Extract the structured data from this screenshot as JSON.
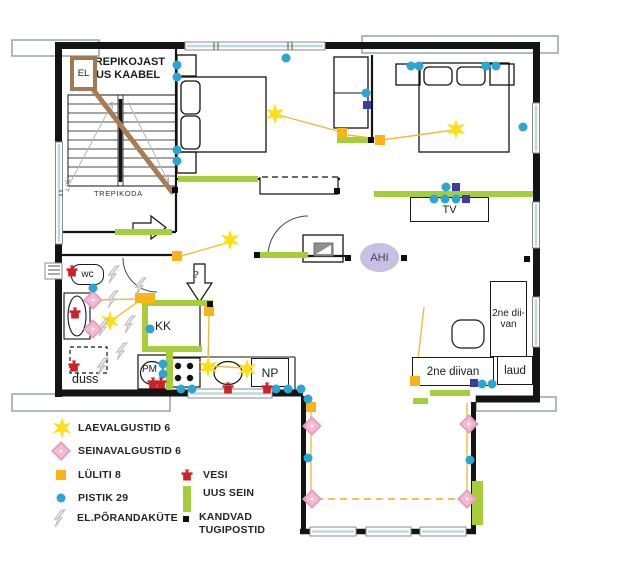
{
  "plan": {
    "labels": {
      "note": "TREPIKOJAST\nUUS KAABEL",
      "el": "EL",
      "trepikoda": "TREPIKODA",
      "stair_dim": "4.85",
      "wc": "wc",
      "duss": "duss",
      "kk": "KK",
      "pm": "PM",
      "np": "NP",
      "tv": "TV",
      "ahi": "AHI",
      "question": "?",
      "sofa_side": "2ne\ndii-\nvan",
      "sofa_bottom": "2ne diivan",
      "laud": "laud"
    },
    "symbols": {
      "ceiling_lights": [
        [
          275,
          114
        ],
        [
          456,
          129
        ],
        [
          230,
          240
        ],
        [
          110,
          321
        ],
        [
          208,
          367
        ],
        [
          247,
          369
        ]
      ],
      "wall_lights": [
        [
          93,
          300
        ],
        [
          93,
          329
        ],
        [
          312,
          426
        ],
        [
          312,
          499
        ],
        [
          469,
          424
        ],
        [
          467,
          499
        ]
      ],
      "switches": [
        [
          177,
          256
        ],
        [
          342,
          133
        ],
        [
          380,
          140
        ],
        [
          140,
          298
        ],
        [
          150,
          298
        ],
        [
          209,
          311
        ],
        [
          311,
          407
        ],
        [
          415,
          381
        ]
      ],
      "sockets": [
        [
          177,
          65
        ],
        [
          177,
          77
        ],
        [
          177,
          150
        ],
        [
          177,
          161
        ],
        [
          286,
          58
        ],
        [
          366,
          93
        ],
        [
          411,
          66
        ],
        [
          419,
          66
        ],
        [
          486,
          66
        ],
        [
          496,
          66
        ],
        [
          523,
          127
        ],
        [
          446,
          187
        ],
        [
          434,
          199
        ],
        [
          445,
          199
        ],
        [
          456,
          199
        ],
        [
          150,
          329
        ],
        [
          163,
          364
        ],
        [
          163,
          374
        ],
        [
          181,
          389
        ],
        [
          192,
          389
        ],
        [
          276,
          389
        ],
        [
          288,
          389
        ],
        [
          301,
          389
        ],
        [
          308,
          399
        ],
        [
          308,
          458
        ],
        [
          470,
          460
        ],
        [
          482,
          384
        ],
        [
          492,
          384
        ],
        [
          93,
          288
        ]
      ],
      "data_outlets": [
        [
          367,
          105
        ],
        [
          456,
          187
        ],
        [
          466,
          199
        ],
        [
          474,
          383
        ]
      ],
      "water_points": [
        [
          72,
          271
        ],
        [
          75,
          313
        ],
        [
          74,
          366
        ],
        [
          153,
          383
        ],
        [
          161,
          383
        ],
        [
          228,
          388
        ],
        [
          267,
          388
        ]
      ],
      "posts": [
        [
          175,
          190
        ],
        [
          257,
          255
        ],
        [
          337,
          191
        ],
        [
          371,
          140
        ],
        [
          348,
          258
        ],
        [
          404,
          258
        ],
        [
          527,
          259
        ],
        [
          210,
          304
        ]
      ],
      "floor_heating": [
        [
          114,
          274
        ],
        [
          141,
          286
        ],
        [
          113,
          299
        ],
        [
          104,
          327
        ],
        [
          130,
          324
        ],
        [
          122,
          351
        ],
        [
          103,
          366
        ]
      ]
    },
    "lines": {
      "solid": [
        [
          275,
          114,
          341,
          132
        ],
        [
          348,
          135,
          378,
          139
        ],
        [
          382,
          140,
          454,
          130
        ],
        [
          230,
          242,
          181,
          256
        ],
        [
          97,
          300,
          137,
          299
        ],
        [
          139,
          301,
          114,
          319
        ],
        [
          209,
          315,
          208,
          364
        ],
        [
          211,
          366,
          245,
          368
        ],
        [
          424,
          307,
          416,
          377
        ],
        [
          311,
          412,
          311,
          497
        ],
        [
          467,
          403,
          467,
          497
        ]
      ],
      "dashed": [
        [
          316,
          499,
          463,
          499
        ]
      ]
    }
  },
  "legend": {
    "items": [
      {
        "symbol": "ceiling-light",
        "label": "LAEVALGUSTID 6"
      },
      {
        "symbol": "wall-light",
        "label": "SEINAVALGUSTID 6"
      },
      {
        "symbol": "switch",
        "label": "LÜLITI 8"
      },
      {
        "symbol": "socket",
        "label": "PISTIK 29"
      },
      {
        "symbol": "floor-heating",
        "label": "EL.PÕRANDAKÜTE"
      },
      {
        "symbol": "water",
        "label": "VESI"
      },
      {
        "symbol": "new-wall",
        "label": "UUS SEIN"
      },
      {
        "symbol": "load-bearing-post",
        "label": "KANDVAD\nTUGIPOSTID"
      }
    ]
  },
  "colors": {
    "ceiling_light": "#FFDE17",
    "wall_light": "#F4B9D3",
    "switch": "#FBB317",
    "socket": "#2AA5D4",
    "data_outlet": "#3D3DA0",
    "water": "#CE2127",
    "new_wall": "#A6CE39",
    "cable": "#A87D55",
    "ahi_fill": "#C9BEE4"
  }
}
